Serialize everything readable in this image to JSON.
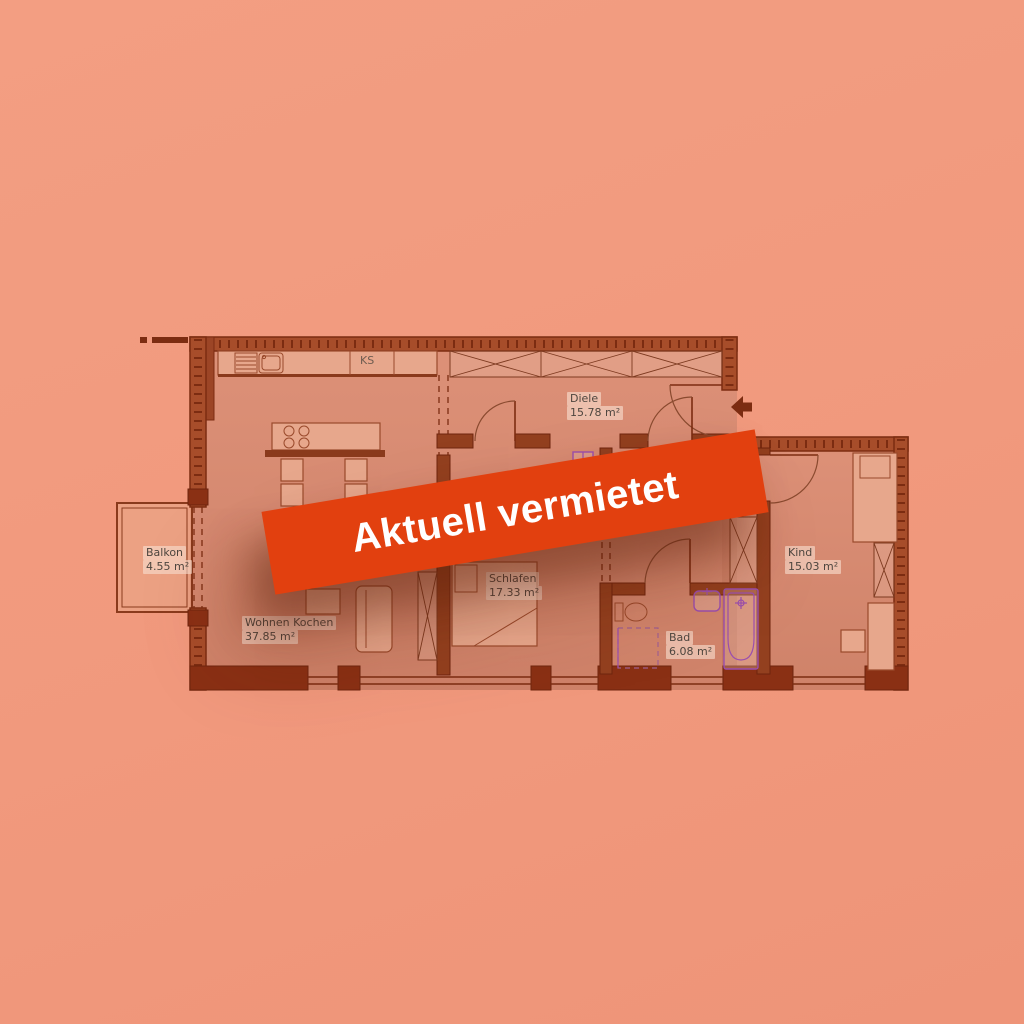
{
  "banner": {
    "text": "Aktuell vermietet"
  },
  "floor_plan": {
    "rooms": [
      {
        "name": "Diele",
        "area": "15.78 m²"
      },
      {
        "name": "Balkon",
        "area": "4.55 m²"
      },
      {
        "name": "Wohnen Kochen",
        "area": "37.85 m²"
      },
      {
        "name": "Schlafen",
        "area": "17.33 m²"
      },
      {
        "name": "Bad",
        "area": "6.08 m²"
      },
      {
        "name": "Kind",
        "area": "15.03 m²"
      }
    ],
    "labels": {
      "fridge": "KS"
    }
  },
  "colors": {
    "background": "#f1997d",
    "floor": "#dd9178",
    "balcony-floor": "#eca183",
    "wall-dark": "#7c2c11",
    "wall-fill": "#a74d2a",
    "wall-interior": "#93401f",
    "wall-solid": "#8a3014",
    "line": "#9a4a2c",
    "furniture-fill": "#e7a78c",
    "fixture": "#9b4fae",
    "banner": "#e2400f",
    "banner-text": "#ffffff",
    "label-text": "#4e463f",
    "label-bg": "rgba(250,225,210,0.6)"
  }
}
